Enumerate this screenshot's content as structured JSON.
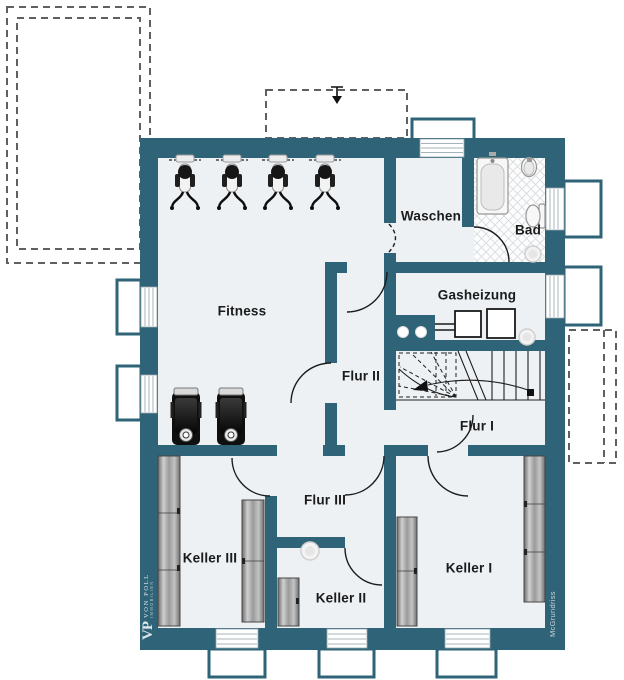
{
  "plan": {
    "rooms": [
      {
        "name": "Fitness"
      },
      {
        "name": "Waschen"
      },
      {
        "name": "Bad"
      },
      {
        "name": "Gasheizung"
      },
      {
        "name": "Flur I"
      },
      {
        "name": "Flur II"
      },
      {
        "name": "Flur III"
      },
      {
        "name": "Keller I"
      },
      {
        "name": "Keller II"
      },
      {
        "name": "Keller III"
      }
    ]
  },
  "branding": {
    "logo_monogram": "VP",
    "logo_name": "VON POLL",
    "logo_subtitle": "IMMOBILIEN",
    "watermark": "McGrundriss"
  },
  "colors": {
    "wall": "#2f6377",
    "floor": "#edf1f4",
    "dashed_outline": "#5d6163"
  }
}
